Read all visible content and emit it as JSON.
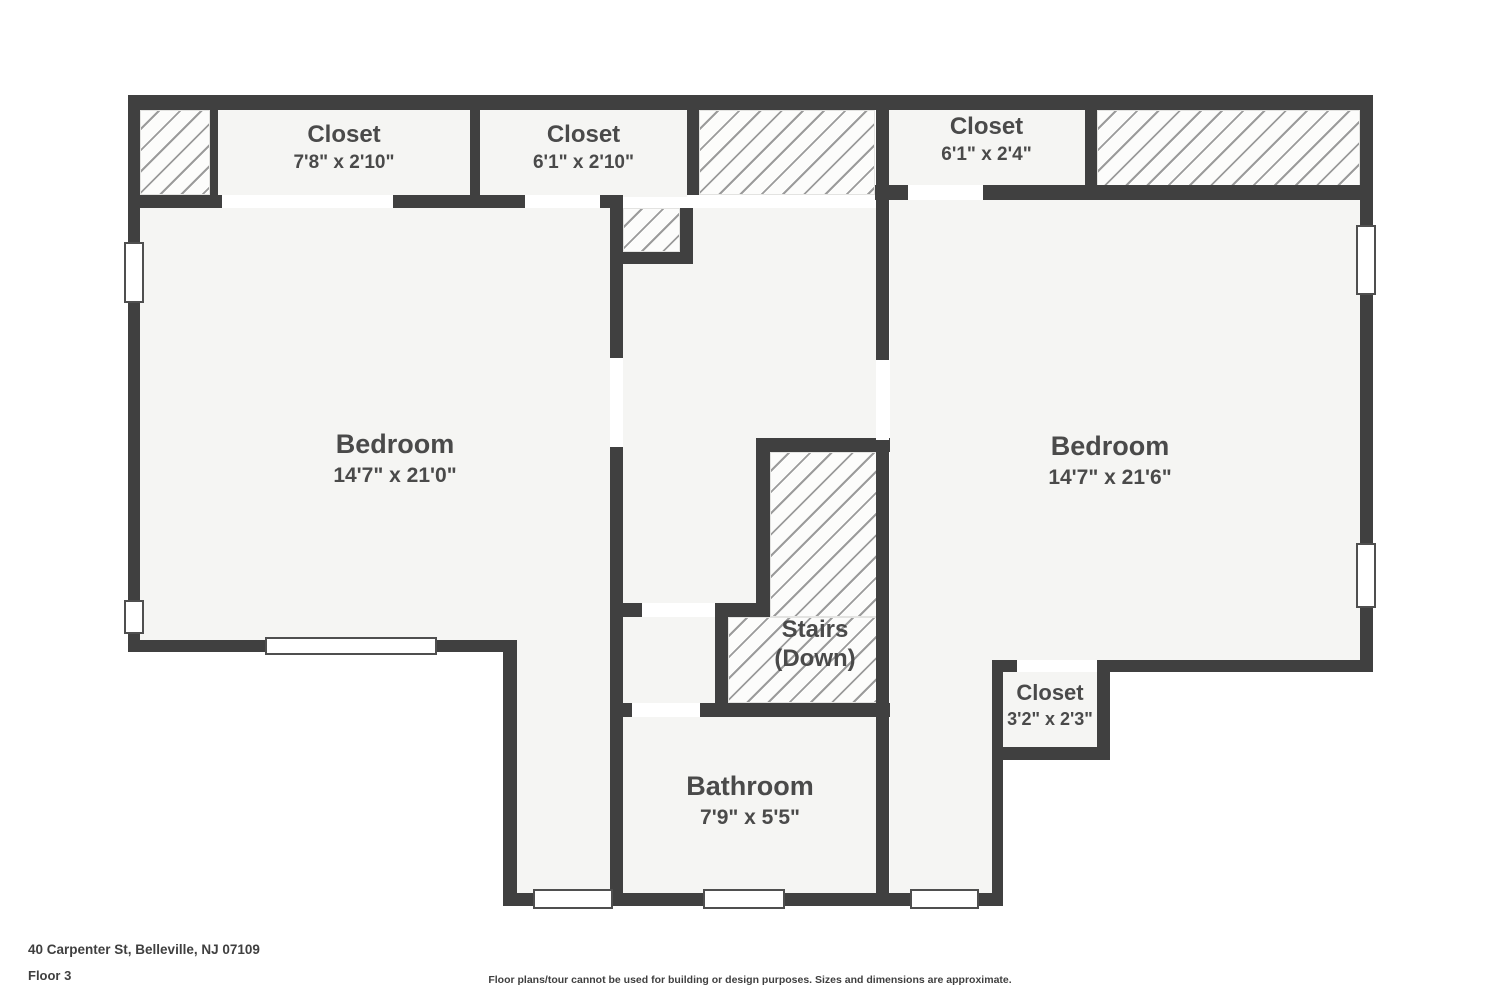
{
  "page": {
    "address": "40 Carpenter St, Belleville, NJ 07109",
    "floor": "Floor 3",
    "disclaimer": "Floor plans/tour cannot be used for building or design purposes. Sizes and dimensions are approximate."
  },
  "rooms": {
    "closet_top_left": {
      "name": "Closet",
      "dims": "7'8\" x 2'10\""
    },
    "closet_top_mid": {
      "name": "Closet",
      "dims": "6'1\" x 2'10\""
    },
    "closet_top_right": {
      "name": "Closet",
      "dims": "6'1\" x 2'4\""
    },
    "bedroom_left": {
      "name": "Bedroom",
      "dims": "14'7\" x 21'0\""
    },
    "bedroom_right": {
      "name": "Bedroom",
      "dims": "14'7\" x 21'6\""
    },
    "stairs": {
      "name": "Stairs",
      "dims": "(Down)"
    },
    "bathroom": {
      "name": "Bathroom",
      "dims": "7'9\" x 5'5\""
    },
    "closet_small": {
      "name": "Closet",
      "dims": "3'2\" x 2'3\""
    }
  },
  "colors": {
    "wall": "#404040",
    "room_fill": "#f5f5f3",
    "hatch_line": "#9b9b9b",
    "label": "#4a4a4a"
  }
}
